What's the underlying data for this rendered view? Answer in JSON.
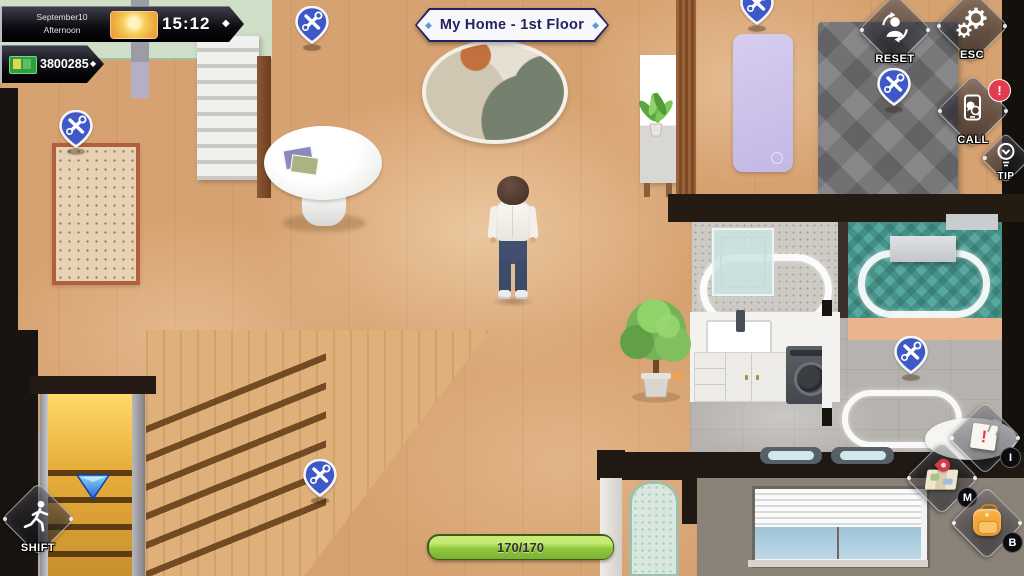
{
  "hud": {
    "datetime": {
      "date": "September10",
      "period": "Afternoon",
      "time": "15:12",
      "separator": "◆"
    },
    "money": {
      "amount": "3800285",
      "separator": "◆"
    },
    "location_banner": {
      "title": "My Home - 1st Floor",
      "left_decor": "◆",
      "right_decor": "◆"
    },
    "stamina_bar": {
      "value": "170/170"
    },
    "buttons": {
      "reset": {
        "label": "RESET"
      },
      "esc": {
        "label": "ESC"
      },
      "call": {
        "label": "CALL",
        "alert_mark": "!"
      },
      "tip": {
        "label": "TIP"
      },
      "shift": {
        "label": "SHIFT"
      },
      "info": {
        "hotkey": "I",
        "alert_mark": "!"
      },
      "map": {
        "hotkey": "M"
      },
      "bag": {
        "hotkey": "B"
      }
    }
  },
  "scene": {
    "pins": [
      {
        "x": 312,
        "y": 22
      },
      {
        "x": 76,
        "y": 126
      },
      {
        "x": 757,
        "y": 3
      },
      {
        "x": 894,
        "y": 84
      },
      {
        "x": 911,
        "y": 352
      },
      {
        "x": 320,
        "y": 475
      }
    ]
  },
  "colors": {
    "pin_blue": "#3f58c7",
    "stamina_green": "#8fc73e",
    "banner_navy": "#23235f",
    "decor_blue": "#5b9bd5",
    "alert_red": "#e23b4e",
    "money_green": "#35aa45"
  }
}
